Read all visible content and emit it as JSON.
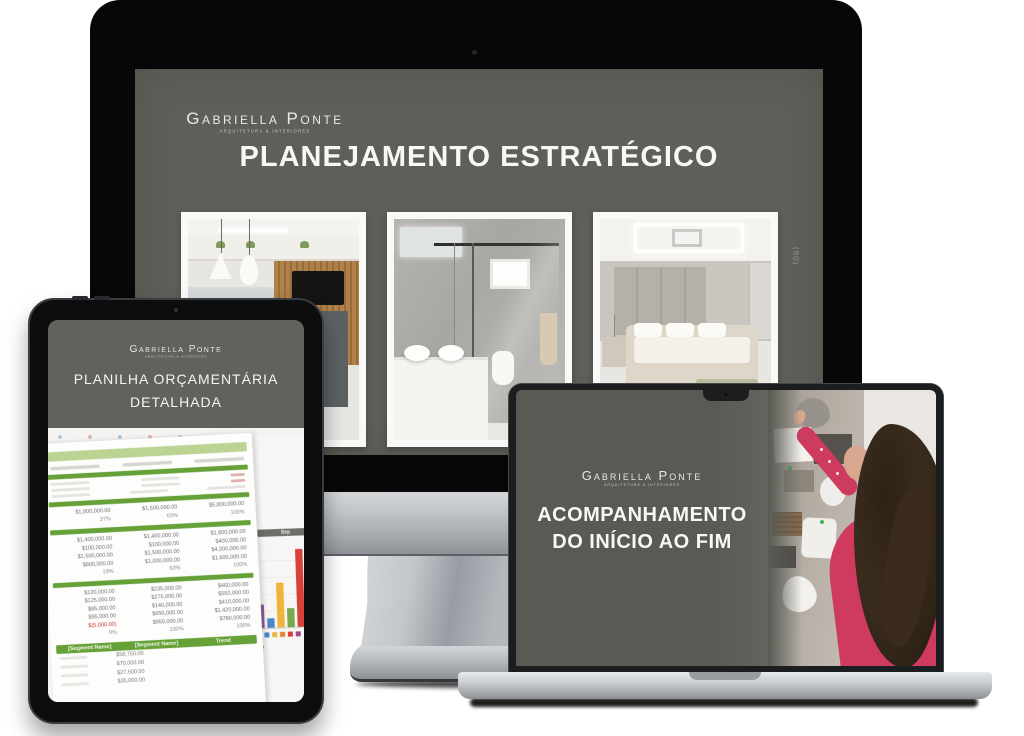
{
  "brand": {
    "name": "Gabriella Ponte",
    "tagline": "ARQUITETURA & INTERIORES"
  },
  "monitor": {
    "title": "PLANEJAMENTO ESTRATÉGICO",
    "side_label": "(80)",
    "photos": [
      {
        "name": "kitchen-interior-render"
      },
      {
        "name": "bathroom-interior-render"
      },
      {
        "name": "bedroom-interior-render"
      }
    ]
  },
  "tablet": {
    "title_line1": "PLANILHA ORÇAMENTÁRIA",
    "title_line2": "DETALHADA",
    "spreadsheet": {
      "upper_total_row": [
        "$1,800,000.00",
        "$1,500,000.00",
        "$5,800,000.00"
      ],
      "upper_pct_row": [
        "37%",
        "63%",
        "100%"
      ],
      "block_a_rows": [
        [
          "$1,400,000.00",
          "$1,400,000.00",
          "$1,800,000.00"
        ],
        [
          "$100,000.00",
          "$100,000.00",
          "$400,000.00"
        ],
        [
          "$1,500,000.00",
          "$1,500,000.00",
          "$4,200,000.00"
        ],
        [
          "$800,000.00",
          "$1,000,000.00",
          "$1,600,000.00"
        ],
        [
          "19%",
          "63%",
          "100%"
        ]
      ],
      "block_b_rows": [
        [
          "$120,000.00",
          "$235,000.00",
          "$460,000.00"
        ],
        [
          "$125,000.00",
          "$275,000.00",
          "$550,000.00"
        ],
        [
          "$85,000.00",
          "$140,000.00",
          "$410,000.00"
        ],
        [
          "$95,000.00",
          "$650,000.00",
          "$1,420,000.00"
        ],
        [
          "$(5,000.00)",
          "$950,000.00",
          "$780,000.00"
        ],
        [
          "0%",
          "100%",
          "100%"
        ]
      ],
      "segment_header": [
        "[Segment Name]",
        "[Segment Name]",
        "Trend"
      ],
      "segment_rows": [
        "$58,750.00",
        "$70,000.00",
        "$27,500.00",
        "$35,000.00"
      ],
      "right_sheet": {
        "header_line1": "Shopping",
        "header_line2": "Cost/Item",
        "value": "$10.00",
        "bar_label": "Sep",
        "month_label_1": "Sep",
        "month_label_2": "Oct",
        "numbers": [
          "93.00",
          "198.00",
          "138.00"
        ]
      }
    }
  },
  "laptop": {
    "title_line1": "ACOMPANHAMENTO",
    "title_line2": "DO INÍCIO AO FIM"
  },
  "chart_data": {
    "type": "bar",
    "title": "",
    "xlabel": "",
    "ylabel": "",
    "categories": [
      "1",
      "2",
      "3",
      "4",
      "5",
      "6",
      "7",
      "8"
    ],
    "values": [
      20,
      8,
      38,
      16,
      66,
      14,
      54,
      34
    ],
    "bar_colors": [
      "#8e5a9e",
      "#4a86c8",
      "#f0b43c",
      "#7aa84c",
      "#d8403a",
      "#b43a78",
      "#46a8c8",
      "#e8832e"
    ],
    "legend_colors": [
      "#8e5a9e",
      "#4a86c8",
      "#f0b43c",
      "#e8832e",
      "#d8403a",
      "#9e4a8e"
    ],
    "grid": true,
    "note_axis": "unlabeled mini chart in spreadsheet photo, heights estimated"
  }
}
